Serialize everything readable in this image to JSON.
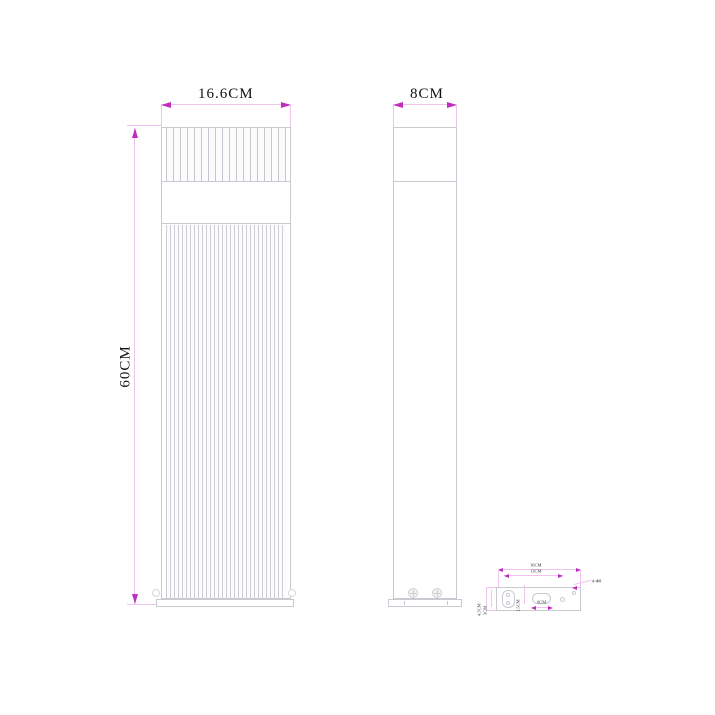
{
  "drawing": {
    "type": "product dimension line drawing (bollard light)",
    "front_view": {
      "width_label": "16.6CM",
      "height_label": "60CM"
    },
    "side_view": {
      "width_label": "8CM"
    },
    "base_detail": {
      "outer_width_label": "16CM",
      "inner_width_label": "13CM",
      "left_outer_height_label": "4.5CM",
      "left_inner_height_label": "3CM",
      "slot_height_label": "1.5CM",
      "slot_width_label": "6CM",
      "holes_label": "4-Φ8"
    },
    "colors": {
      "background": "#ffffff",
      "object_lines": "#c9c9d1",
      "dimension_lines": "#eec4ee",
      "arrowheads": "#c02ec0",
      "text": "#1a1a1a"
    }
  }
}
